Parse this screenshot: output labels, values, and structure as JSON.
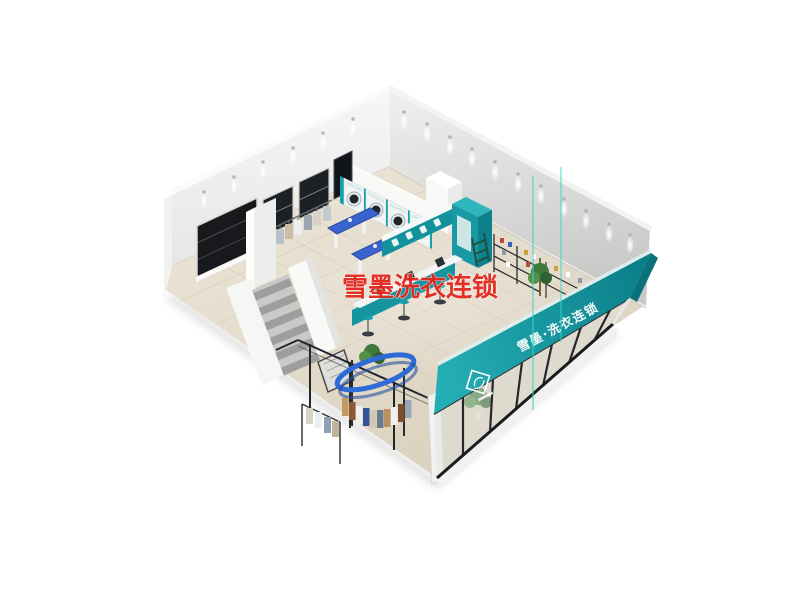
{
  "image": {
    "kind": "3d-interior-render",
    "subject": "laundry store interior, bird's-eye cutaway 3D rendering",
    "background_color": "#ffffff"
  },
  "watermark": {
    "text": "雪墨洗衣连锁",
    "color": "#e3271c"
  },
  "storefront": {
    "sign_text": "雪墨·洗衣连锁",
    "band_color": "#17a0aa",
    "logo": "diamond-swan-emblem"
  },
  "palette": {
    "teal": "#17a0aa",
    "teal_dark": "#0c818b",
    "wall_light": "#f4f4f3",
    "wall_shade": "#cbcbc9",
    "floor": "#e8e1d2",
    "accent_blue": "#3a63cf",
    "conveyor_blue": "#2f6bd8",
    "window_dark": "#17191d",
    "stair_gray": "#a8a8a6",
    "plant_green": "#3f7a3c",
    "artifact_line": "#35d6c6",
    "watermark_red": "#e3271c"
  },
  "objects": [
    "back-left-wall-with-windows",
    "back-right-wall",
    "ceiling-downlights",
    "washer-dryer-row",
    "wall-tv",
    "white-cabinet-column",
    "teal-partition",
    "reception-counters",
    "bar-stools",
    "ironing-tables",
    "hanging-clothes-rail",
    "display-shelves",
    "ladder-shelf",
    "potted-plants",
    "garment-conveyor",
    "glass-fitting-room",
    "staircase",
    "floor-mat",
    "storefront-sign-band",
    "brand-logo",
    "storefront-glass",
    "render-artifact-lines",
    "red-watermark"
  ]
}
